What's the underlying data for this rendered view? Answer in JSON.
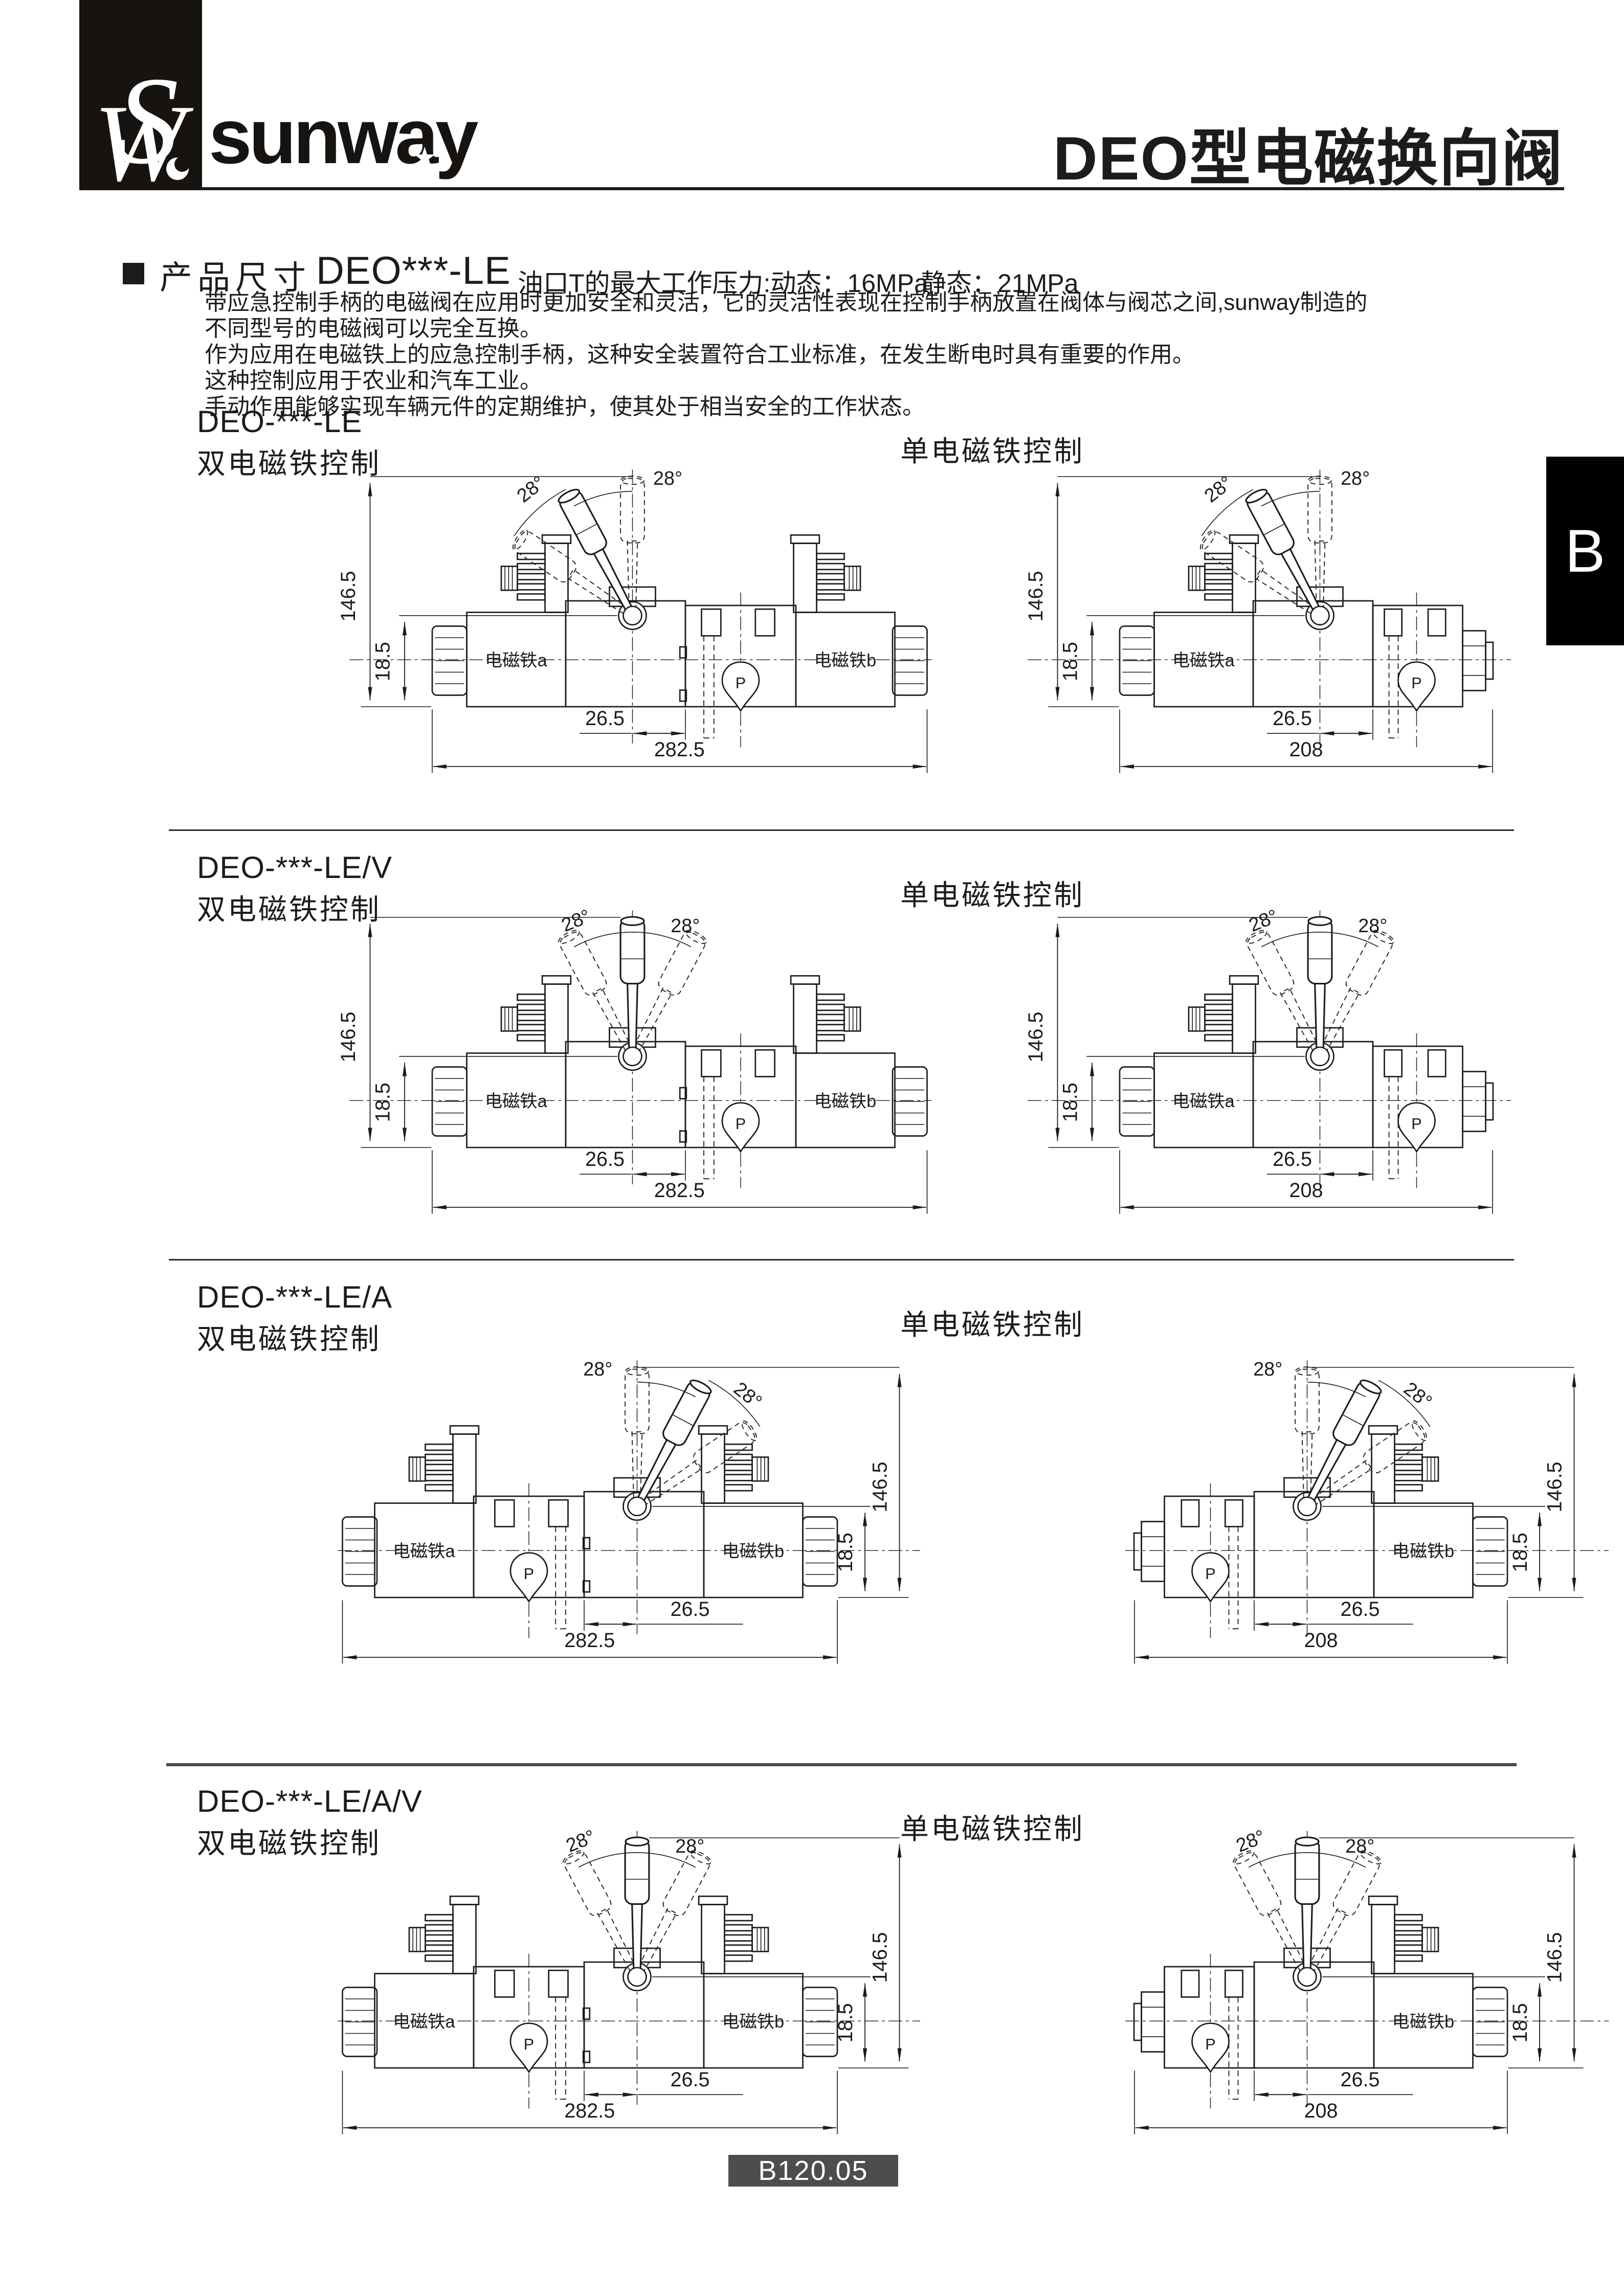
{
  "header": {
    "logo_monogram": "SW",
    "logo_text": "sunway",
    "logo_star": "★",
    "title": "DEO型电磁换向阀"
  },
  "side_tab": {
    "label": "B"
  },
  "product_section": {
    "heading": "产品尺寸",
    "model": "DEO***-LE",
    "pressure_note_dynamic": "油口T的最大工作压力:动态：16MPa",
    "pressure_note_static": "静态：21MPa",
    "description_lines": [
      "带应急控制手柄的电磁阀在应用时更加安全和灵活，它的灵活性表现在控制手柄放置在阀体与阀芯之间,sunway制造的",
      "不同型号的电磁阀可以完全互换。",
      "作为应用在电磁铁上的应急控制手柄，这种安全装置符合工业标准，在发生断电时具有重要的作用。",
      "这种控制应用于农业和汽车工业。",
      "手动作用能够实现车辆元件的定期维护，使其处于相当安全的工作状态。"
    ]
  },
  "drawing_labels": {
    "solenoid_a": "电磁铁a",
    "solenoid_b": "电磁铁b",
    "p_symbol": "P",
    "angle": "28°",
    "dim_total_height": "146.5",
    "dim_pivot_height": "18.5",
    "dim_pivot_offset": "26.5",
    "dim_width_double": "282.5",
    "dim_width_single": "208"
  },
  "sections": [
    {
      "model": "DEO-***-LE",
      "double_label": "双电磁铁控制",
      "single_label": "单电磁铁控制"
    },
    {
      "model": "DEO-***-LE/V",
      "double_label": "双电磁铁控制",
      "single_label": "单电磁铁控制"
    },
    {
      "model": "DEO-***-LE/A",
      "double_label": "双电磁铁控制",
      "single_label": "单电磁铁控制"
    },
    {
      "model": "DEO-***-LE/A/V",
      "double_label": "双电磁铁控制",
      "single_label": "单电磁铁控制"
    }
  ],
  "footer": {
    "page_code": "B120.05"
  },
  "colors": {
    "ink": "#1c1c1c",
    "tab_bg": "#000000",
    "badge_bg": "#4d4d4d",
    "paper": "#ffffff"
  }
}
